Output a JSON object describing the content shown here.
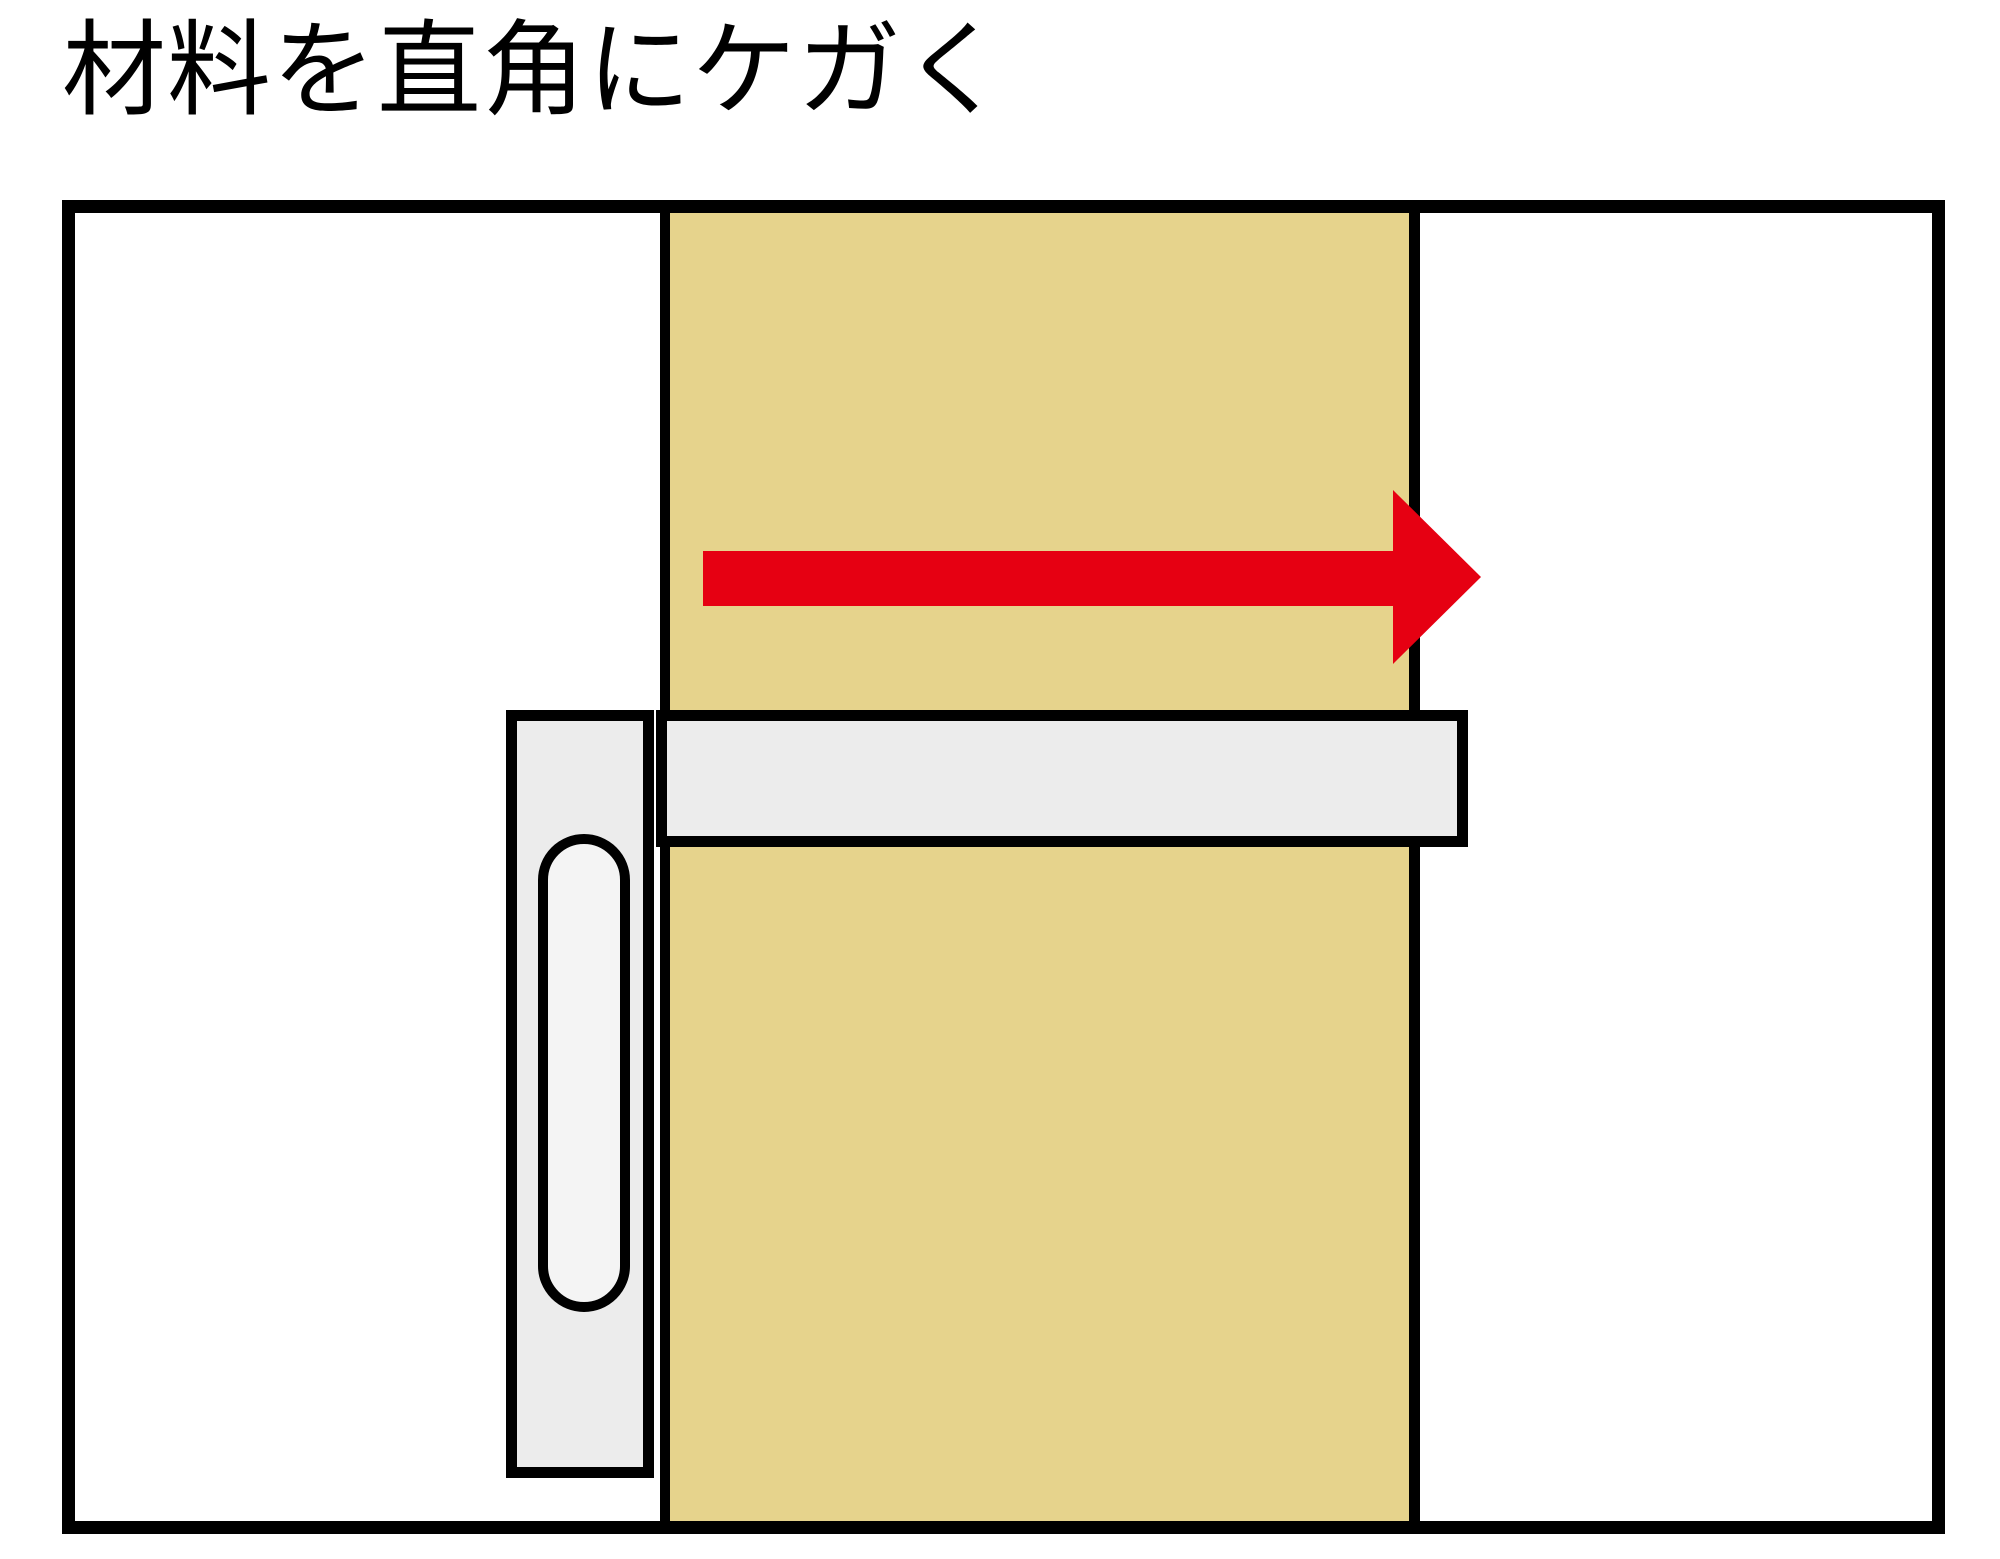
{
  "title": "材料を直角にケガく",
  "diagram": {
    "icons": {
      "direction": "right-arrow-icon"
    },
    "colors": {
      "background": "#ffffff",
      "title_text": "#000000",
      "outline": "#000000",
      "wood": "#e6d38c",
      "tool": "#ececec",
      "slot": "#f4f4f4",
      "arrow": "#e60012"
    }
  }
}
